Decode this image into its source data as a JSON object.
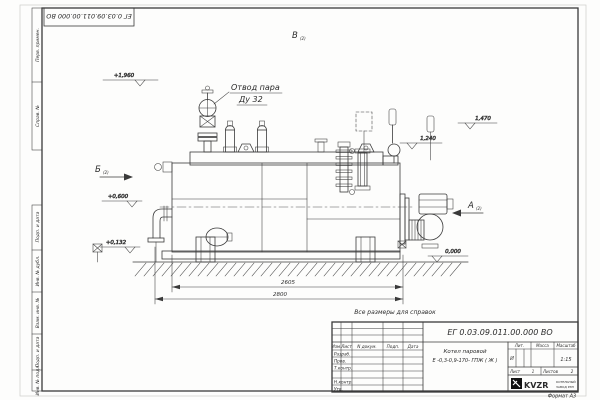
{
  "drawing": {
    "stamp_top_text": "ЕГ 0.03.09.011.00.000  ВО",
    "margin": {
      "upper_cells": [
        "Перв. примен.",
        "Справ. №"
      ],
      "lower_cells": [
        "Подп. и дата",
        "Инв. № дубл.",
        "Взам. инв. №",
        "Подп. и дата",
        "Инв. № подл."
      ]
    },
    "views": {
      "b_label": "Б",
      "v_label": "В",
      "a_label": "А",
      "sheet_ref": "(2)"
    },
    "callout": {
      "line1": "Отвод пара",
      "line2": "Ду 32"
    },
    "elevations": {
      "top": "+1,960",
      "left_mid": "+0,600",
      "left_low": "+0,132",
      "right_mid": "1,240",
      "right_high": "1,470",
      "base": "0,000"
    },
    "dimensions": {
      "inner": "2605",
      "overall": "2800"
    },
    "note": "Все размеры для справок",
    "format_note": "Формат А3"
  },
  "title_block": {
    "doc_number": "ЕГ 0.03.09.011.00.000  ВО",
    "name_line1": "Котел паровой",
    "name_line2": "Е -0,3-0,9-170- ГПЖ ( Ж )",
    "header": {
      "izm": "Изм.",
      "list": "Лист",
      "doc": "N докум.",
      "podp": "Подп.",
      "data": "Дата"
    },
    "rows": [
      "Разраб.",
      "Пров.",
      "Т.контр.",
      "",
      "Н.контр.",
      "Утв."
    ],
    "lit_label": "Лит.",
    "lit_value": "И",
    "mass_label": "Масса",
    "scale_label": "Масштаб",
    "scale_value": "1:15",
    "sheet_label": "Лист",
    "sheet_value": "1",
    "sheets_label": "Листов",
    "sheets_value": "2",
    "brand": "KVZR",
    "brand_sub1": "КОТЕЛЬНЫЙ",
    "brand_sub2": "ЗАВОД РЭП"
  },
  "colors": {
    "line": "#3a3a3a",
    "text": "#2b2b2b",
    "paper": "#fdfdfc"
  }
}
